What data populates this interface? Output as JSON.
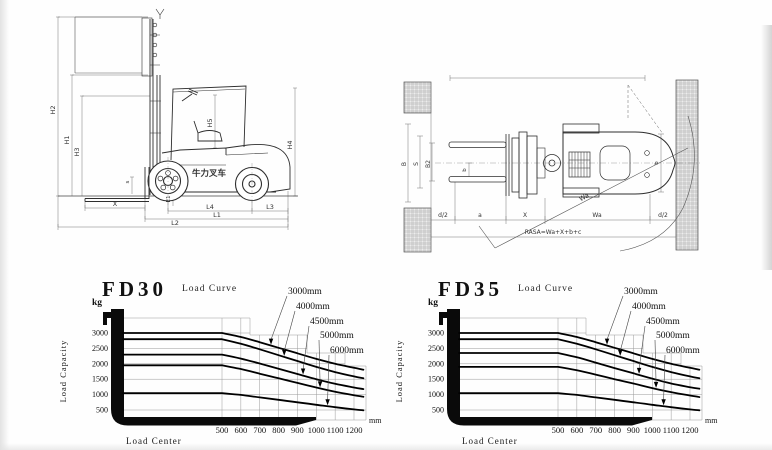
{
  "page": {
    "title": "Forklift datasheet drawings and load curves"
  },
  "colors": {
    "art_line": "#2e2e2e",
    "dim_line": "#777777",
    "grid": "#9a9a9a",
    "curve": "#000000",
    "fork_axis": "#0a0a0a",
    "hatch_bg": "#ededed",
    "hatch_line": "#8f8f8f",
    "text": "#1a1a1a"
  },
  "side_view": {
    "brand_text": "牛力叉车",
    "dim_labels": [
      {
        "t": "H2",
        "x": 25,
        "y": 105,
        "r": -90,
        "fs": 6.5
      },
      {
        "t": "H1",
        "x": 39,
        "y": 135,
        "r": -90,
        "fs": 6.5
      },
      {
        "t": "H3",
        "x": 49,
        "y": 147,
        "r": -90,
        "fs": 6.5
      },
      {
        "t": "s",
        "x": 99,
        "y": 177,
        "r": -90,
        "fs": 5.5
      },
      {
        "t": "H5",
        "x": 182,
        "y": 118,
        "r": -90,
        "fs": 6.5
      },
      {
        "t": "H4",
        "x": 262,
        "y": 140,
        "r": -90,
        "fs": 6.5
      },
      {
        "t": "E1",
        "x": 140,
        "y": 194,
        "r": -90,
        "fs": 5.5
      },
      {
        "t": "X",
        "x": 85,
        "y": 201,
        "r": 0,
        "fs": 6.5
      },
      {
        "t": "L4",
        "x": 180,
        "y": 204,
        "r": 0,
        "fs": 6.5
      },
      {
        "t": "L3",
        "x": 240,
        "y": 204,
        "r": 0,
        "fs": 6.5
      },
      {
        "t": "L1",
        "x": 187,
        "y": 212,
        "r": 0,
        "fs": 6.5
      },
      {
        "t": "L2",
        "x": 145,
        "y": 220,
        "r": 0,
        "fs": 6.5
      }
    ]
  },
  "top_view": {
    "formula": "RASA=Wa+X+b+c",
    "dim_labels": [
      {
        "t": "B",
        "x": 11,
        "y": 106,
        "r": -90,
        "fs": 6
      },
      {
        "t": "S",
        "x": 23,
        "y": 106,
        "r": -90,
        "fs": 6
      },
      {
        "t": "B2",
        "x": 35,
        "y": 106,
        "r": -90,
        "fs": 6
      },
      {
        "t": "b",
        "x": 71,
        "y": 112,
        "r": -90,
        "fs": 5.5
      },
      {
        "t": "b",
        "x": 263,
        "y": 105,
        "r": -90,
        "fs": 5.5
      },
      {
        "t": "Wa",
        "x": 190,
        "y": 141,
        "r": -28,
        "fs": 6.5
      },
      {
        "t": "d/2",
        "x": 48,
        "y": 159,
        "r": 0,
        "fs": 6
      },
      {
        "t": "a",
        "x": 85,
        "y": 159,
        "r": 0,
        "fs": 6
      },
      {
        "t": "X",
        "x": 130,
        "y": 159,
        "r": 0,
        "fs": 6
      },
      {
        "t": "Wa",
        "x": 202,
        "y": 159,
        "r": 0,
        "fs": 6
      },
      {
        "t": "d/2",
        "x": 268,
        "y": 159,
        "r": 0,
        "fs": 6
      },
      {
        "t": "RASA=Wa+X+b+c",
        "x": 158,
        "y": 176,
        "r": 0,
        "fs": 6
      }
    ]
  },
  "chart_data": [
    {
      "type": "line",
      "model": "FD30",
      "subtitle": "Load Curve",
      "y_unit": "kg",
      "x_unit": "mm",
      "ylabel": "Load Capacity",
      "xlabel": "Load Center",
      "yticks": [
        3000,
        2500,
        2000,
        1500,
        1000,
        500
      ],
      "xticks": [
        500,
        600,
        700,
        800,
        900,
        1000,
        1100,
        1200
      ],
      "ylim": [
        0,
        3500
      ],
      "xlim": [
        0,
        1250
      ],
      "series_x": [
        500,
        600,
        700,
        800,
        900,
        1000,
        1100,
        1200,
        1250
      ],
      "series": [
        {
          "label": "3000mm",
          "anchor_x": 760,
          "y": [
            3000,
            2870,
            2700,
            2520,
            2340,
            2160,
            2000,
            1870,
            1810
          ]
        },
        {
          "label": "4000mm",
          "anchor_x": 830,
          "y": [
            2800,
            2650,
            2470,
            2280,
            2090,
            1900,
            1730,
            1590,
            1530
          ]
        },
        {
          "label": "4500mm",
          "anchor_x": 930,
          "y": [
            2300,
            2170,
            2010,
            1840,
            1670,
            1500,
            1350,
            1230,
            1180
          ]
        },
        {
          "label": "5000mm",
          "anchor_x": 1020,
          "y": [
            1950,
            1830,
            1680,
            1530,
            1380,
            1230,
            1090,
            980,
            930
          ]
        },
        {
          "label": "6000mm",
          "anchor_x": 1060,
          "y": [
            1050,
            990,
            910,
            830,
            750,
            670,
            590,
            520,
            490
          ]
        }
      ]
    },
    {
      "type": "line",
      "model": "FD35",
      "subtitle": "Load Curve",
      "y_unit": "kg",
      "x_unit": "mm",
      "ylabel": "Load Capacity",
      "xlabel": "Load Center",
      "yticks": [
        3000,
        2500,
        2000,
        1500,
        1000,
        500
      ],
      "xticks": [
        500,
        600,
        700,
        800,
        900,
        1000,
        1100,
        1200
      ],
      "ylim": [
        0,
        3500
      ],
      "xlim": [
        0,
        1250
      ],
      "series_x": [
        500,
        600,
        700,
        800,
        900,
        1000,
        1100,
        1200,
        1250
      ],
      "series": [
        {
          "label": "3000mm",
          "anchor_x": 760,
          "y": [
            3000,
            2870,
            2700,
            2520,
            2340,
            2160,
            2000,
            1870,
            1810
          ]
        },
        {
          "label": "4000mm",
          "anchor_x": 830,
          "y": [
            2800,
            2650,
            2470,
            2280,
            2090,
            1900,
            1730,
            1590,
            1530
          ]
        },
        {
          "label": "4500mm",
          "anchor_x": 930,
          "y": [
            2350,
            2210,
            2040,
            1860,
            1690,
            1520,
            1360,
            1240,
            1190
          ]
        },
        {
          "label": "5000mm",
          "anchor_x": 1020,
          "y": [
            1900,
            1790,
            1650,
            1500,
            1360,
            1210,
            1080,
            970,
            920
          ]
        },
        {
          "label": "6000mm",
          "anchor_x": 1060,
          "y": [
            1050,
            990,
            910,
            830,
            750,
            670,
            590,
            520,
            490
          ]
        }
      ]
    }
  ]
}
